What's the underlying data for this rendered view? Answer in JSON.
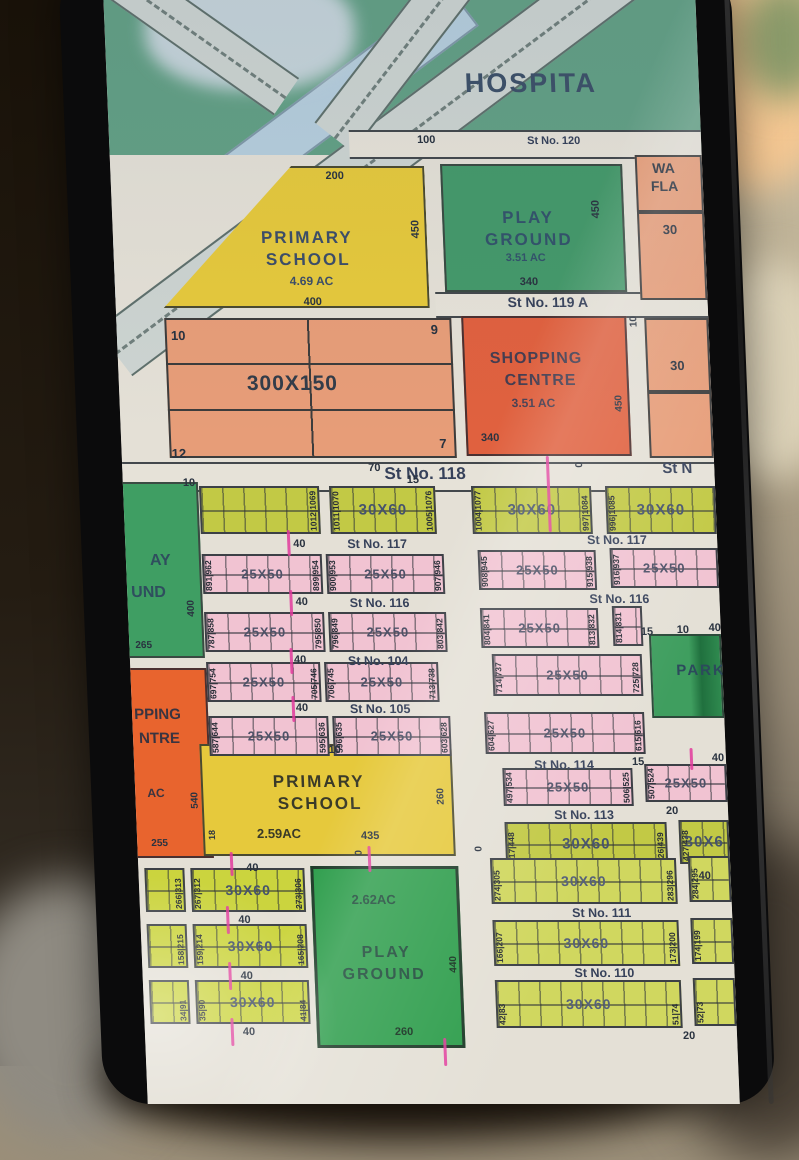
{
  "map": {
    "hospital": {
      "name": "HOSPITA",
      "dim": "100",
      "street": "St No. 120"
    },
    "flats": {
      "line1": "WA",
      "line2": "FLA",
      "plot1": "30",
      "plot2": "30",
      "dim_side": "10"
    },
    "school_top": {
      "line1": "PRIMARY",
      "line2": "SCHOOL",
      "area": "4.69 AC",
      "dim_top": "200",
      "dim_right": "450",
      "dim_bottom": "400"
    },
    "play_top": {
      "line1": "PLAY",
      "line2": "GROUND",
      "area": "3.51 AC",
      "dim_right": "450",
      "dim_bottom": "340"
    },
    "st119a": "St No. 119 A",
    "grid300": {
      "label": "300X150",
      "p1": "10",
      "p2": "9",
      "p3": "7",
      "p4": "12"
    },
    "shopping": {
      "line1": "SHOPPING",
      "line2": "CENTRE",
      "area": "3.51 AC",
      "dim_bottom": "340",
      "dim_right": "450"
    },
    "st118": {
      "label": "St No. 118",
      "right": "St N",
      "d1": "70",
      "d2": "15",
      "d3": "10",
      "d4": "0"
    },
    "play_left": {
      "line1": "AY",
      "line2": "UND",
      "dim_right": "400",
      "dim_bottom": "265"
    },
    "shop_left": {
      "line1": "PPING",
      "line2": "NTRE",
      "area": "AC",
      "dim_right": "540",
      "dim_bottom": "255"
    },
    "park": {
      "name": "PARK"
    },
    "school_low": {
      "line1": "PRIMARY",
      "line2": "SCHOOL",
      "area": "2.59AC",
      "dim_top": "10",
      "dim_bottom": "435",
      "dim_right": "260",
      "dim_left": "18",
      "dim_below": "40",
      "dim_zero": "0"
    },
    "play_low": {
      "area": "2.62AC",
      "line1": "PLAY",
      "line2": "GROUND",
      "dim_bottom": "260",
      "dim_right": "440",
      "dim_top": "0"
    },
    "streets": {
      "st117": "St No. 117",
      "st116": "St No. 116",
      "st104": "St No. 104",
      "st105": "St No. 105",
      "st114": "St No. 114",
      "st113": "St No. 113",
      "st111": "St No. 111",
      "st110": "St No. 110"
    },
    "dims": {
      "d40": "40",
      "d20": "20",
      "d15": "15",
      "d10": "10"
    },
    "rows": {
      "r118": {
        "blocks": [
          {
            "r": "1012|1069"
          },
          {
            "l": "1011|1070",
            "c": "30X60",
            "r": "1005|1076"
          },
          {
            "l": "1004|1077",
            "c": "30X60",
            "r": "997|1084"
          },
          {
            "l": "996|1085",
            "c": "30X60"
          }
        ]
      },
      "r117": {
        "blocks": [
          {
            "l": "891|962",
            "c": "25X50",
            "r": "899|954"
          },
          {
            "l": "900|953",
            "c": "25X50",
            "r": "907|946"
          },
          {
            "l": "908|945",
            "c": "25X50",
            "r": "915|938"
          },
          {
            "l": "916|937",
            "c": "25X50"
          }
        ]
      },
      "r116": {
        "blocks": [
          {
            "l": "787|858",
            "c": "25X50",
            "r": "795|850"
          },
          {
            "l": "796|849",
            "c": "25X50",
            "r": "803|842"
          },
          {
            "l": "804|841",
            "c": "25X50",
            "r": "813|832"
          },
          {
            "l": "814|831",
            "c": "25X5"
          }
        ]
      },
      "r104": {
        "blocks": [
          {
            "l": "697|754",
            "c": "25X50",
            "r": "705|746"
          },
          {
            "l": "706|745",
            "c": "25X50",
            "r": "713|738"
          },
          {
            "l": "714|737",
            "c": "25X50",
            "r": "725|728"
          }
        ]
      },
      "r105": {
        "blocks": [
          {
            "l": "587|644",
            "c": "25X50",
            "r": "595|636"
          },
          {
            "l": "596|635",
            "c": "25X50",
            "r": "603|628"
          },
          {
            "l": "604|627",
            "c": "25X50",
            "r": "615|616"
          }
        ]
      },
      "r114": {
        "blocks": [
          {
            "l": "497|534",
            "c": "25X50",
            "r": "506|525"
          },
          {
            "l": "507|524",
            "c": "25X50"
          }
        ]
      },
      "r113": {
        "blocks": [
          {
            "l": "417|448",
            "c": "30X60",
            "r": "426|439"
          },
          {
            "l": "427|438",
            "c": "30X6"
          }
        ]
      },
      "bl1": {
        "blocks": [
          {
            "r": "266|313"
          },
          {
            "l": "267|312",
            "c": "30X60",
            "r": "273|306"
          }
        ]
      },
      "bl2": {
        "blocks": [
          {
            "r": "158|215"
          },
          {
            "l": "159|214",
            "c": "30X60",
            "r": "165|208"
          }
        ]
      },
      "bl3": {
        "blocks": [
          {
            "r": "34|91"
          },
          {
            "l": "35|90",
            "c": "30X60",
            "r": "41|84"
          }
        ]
      },
      "br1": {
        "blocks": [
          {
            "l": "274|305",
            "c": "30X60",
            "r": "283|296"
          },
          {
            "l": "284|295"
          }
        ]
      },
      "br2": {
        "blocks": [
          {
            "l": "166|207",
            "c": "30X60",
            "r": "173|200"
          },
          {
            "l": "174|199"
          }
        ]
      },
      "br3": {
        "blocks": [
          {
            "l": "42|83",
            "c": "30X60",
            "r": "51|74"
          },
          {
            "l": "52|73"
          }
        ]
      }
    }
  }
}
